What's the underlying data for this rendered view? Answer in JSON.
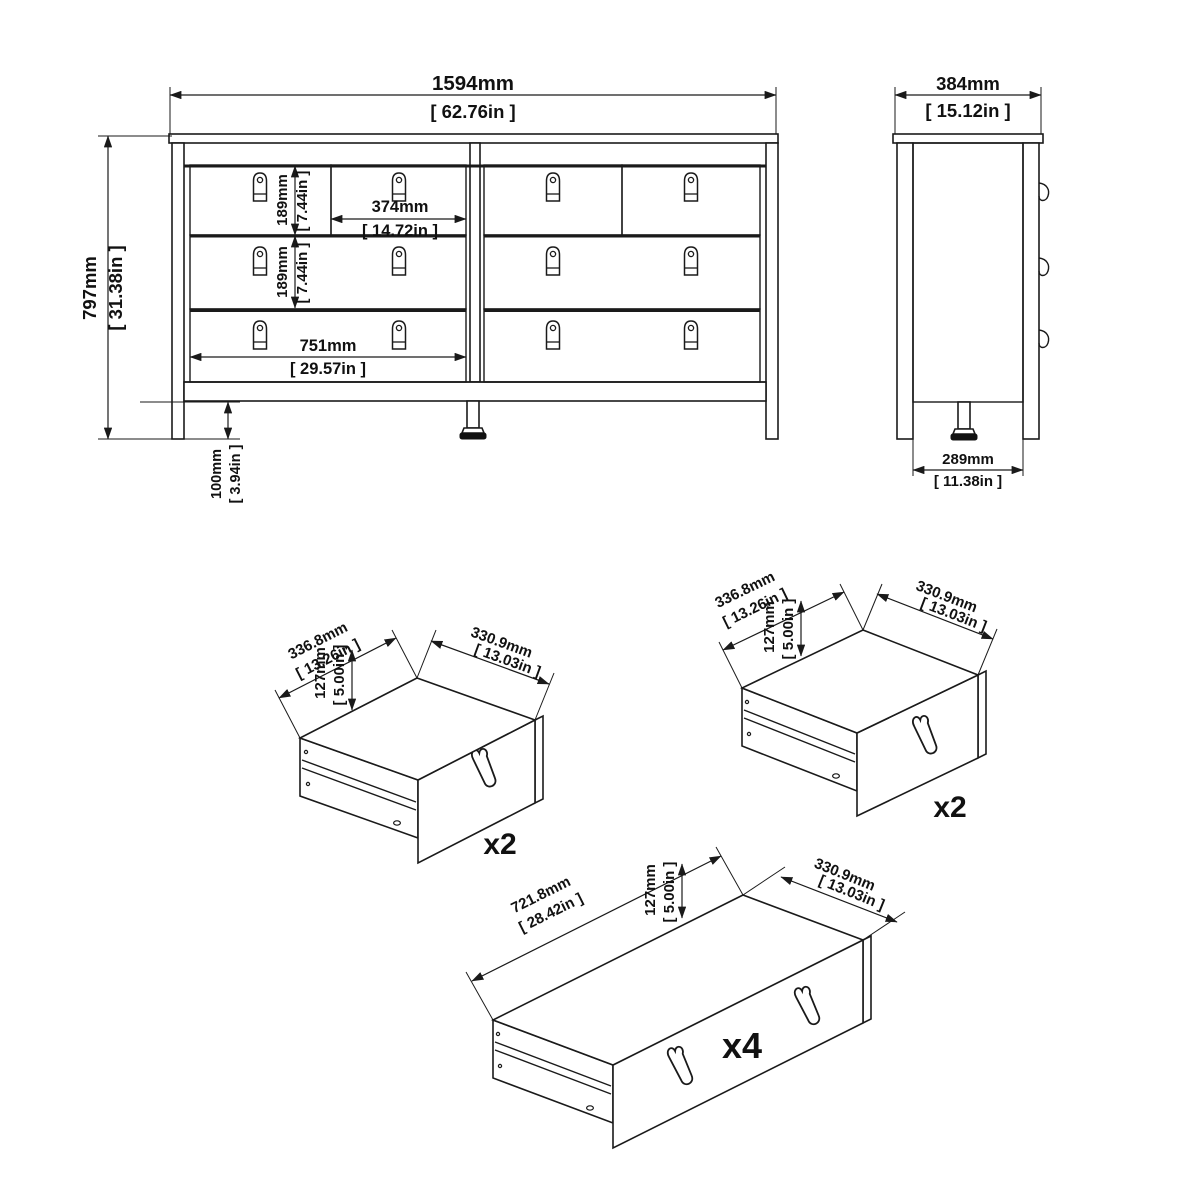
{
  "front_view": {
    "width_mm": "1594mm",
    "width_in": "[ 62.76in ]",
    "height_mm": "797mm",
    "height_in": "[ 31.38in ]",
    "row1_mm": "189mm",
    "row1_in": "[ 7.44in ]",
    "row2_mm": "189mm",
    "row2_in": "[ 7.44in ]",
    "half_width_mm": "374mm",
    "half_width_in": "[ 14.72in ]",
    "drawer_width_mm": "751mm",
    "drawer_width_in": "[ 29.57in ]",
    "leg_mm": "100mm",
    "leg_in": "[ 3.94in ]"
  },
  "side_view": {
    "depth_mm": "384mm",
    "depth_in": "[ 15.12in ]",
    "base_mm": "289mm",
    "base_in": "[ 11.38in ]"
  },
  "drawer_small_left": {
    "width_mm": "336.8mm",
    "width_in": "[ 13.26in ]",
    "height_mm": "127mm",
    "height_in": "[ 5.00in ]",
    "depth_mm": "330.9mm",
    "depth_in": "[ 13.03in ]",
    "qty": "x2"
  },
  "drawer_small_right": {
    "width_mm": "336.8mm",
    "width_in": "[ 13.26in ]",
    "height_mm": "127mm",
    "height_in": "[ 5.00in ]",
    "depth_mm": "330.9mm",
    "depth_in": "[ 13.03in ]",
    "qty": "x2"
  },
  "drawer_large": {
    "length_mm": "721.8mm",
    "length_in": "[ 28.42in ]",
    "height_mm": "127mm",
    "height_in": "[ 5.00in ]",
    "depth_mm": "330.9mm",
    "depth_in": "[ 13.03in ]",
    "qty": "x4"
  }
}
